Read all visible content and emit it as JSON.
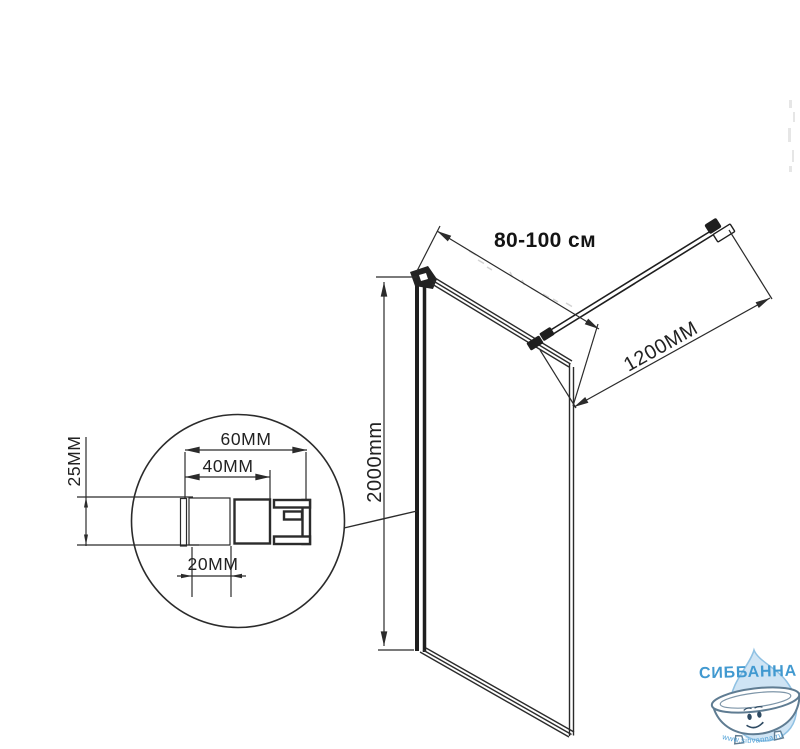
{
  "diagram": {
    "width_range_label": "80-100 см",
    "bar_length_label": "1200MM",
    "height_label": "2000mm",
    "detail": {
      "overall_width": "60MM",
      "inner_width": "40MM",
      "profile_height": "25MM",
      "slot_width": "20MM"
    }
  },
  "watermark": {
    "brand": "СИББАННА",
    "url": "www.sibvanna.ru"
  },
  "colors": {
    "line": "#2b2b2b",
    "brand_blue": "#4199d0",
    "url_blue": "#4fa0d6",
    "drop_fill": "#cfe4f4",
    "drop_stroke": "#8fc1e3",
    "tub_outline": "#5f7c92",
    "background": "#ffffff"
  }
}
